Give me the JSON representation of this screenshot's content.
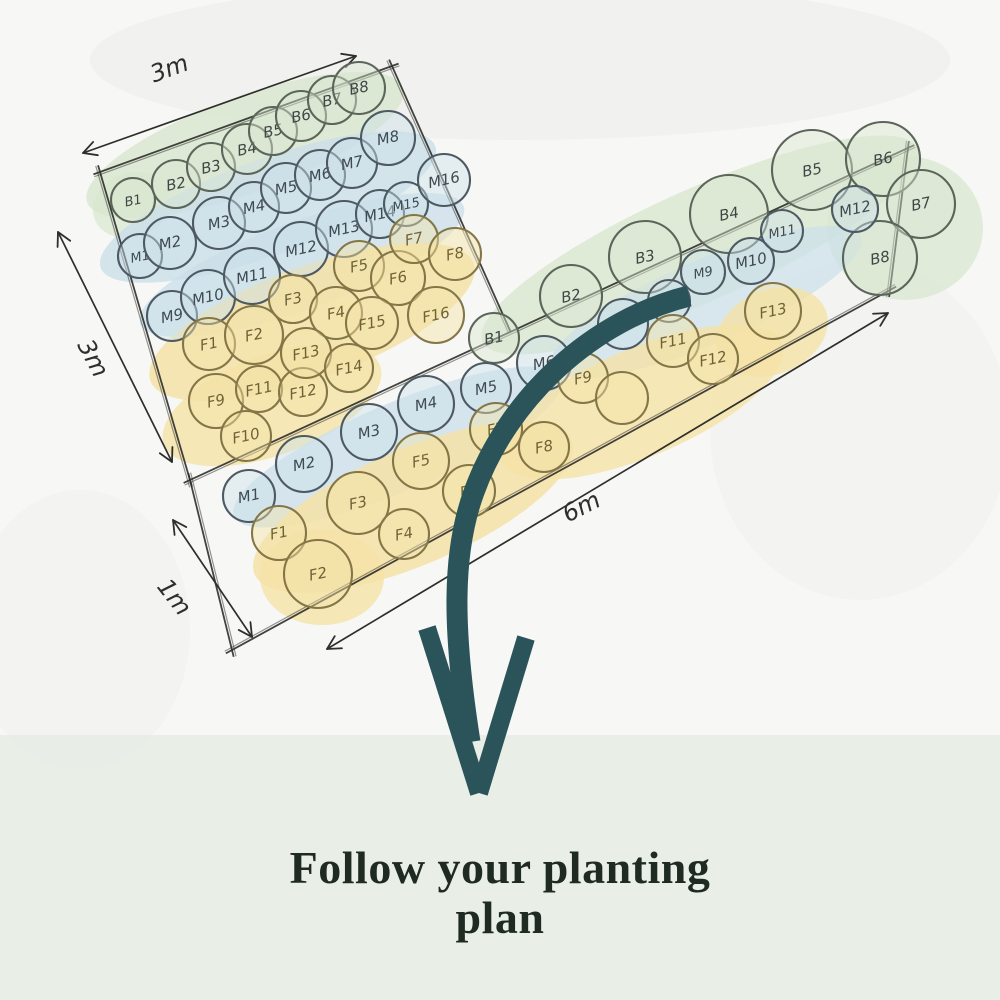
{
  "caption": {
    "line1": "Follow your planting",
    "line2": "plan"
  },
  "colors": {
    "paper": "#f7f7f5",
    "band": "#e9efe7",
    "green": "#d9e7d0",
    "blue": "#cbdfe9",
    "yellow": "#f5e2a6",
    "gray": "#ececea",
    "ink": "#2e2e2a",
    "teal": "#2a545a",
    "b_stroke": "#5c655a",
    "m_stroke": "#4d5a63",
    "f_stroke": "#857647",
    "b_text": "#3f4746",
    "m_text": "#3f4a52",
    "f_text": "#6f6236",
    "caption_text": "#1f2a22"
  },
  "dimensions": [
    {
      "label": "3m",
      "x1": 83,
      "y1": 153,
      "x2": 356,
      "y2": 56,
      "lx": 172,
      "ly": 76,
      "angle": -20
    },
    {
      "label": "3m",
      "x1": 58,
      "y1": 232,
      "x2": 172,
      "y2": 462,
      "lx": 86,
      "ly": 362,
      "angle": 62
    },
    {
      "label": "1m",
      "x1": 173,
      "y1": 520,
      "x2": 252,
      "y2": 637,
      "lx": 168,
      "ly": 602,
      "angle": 52
    },
    {
      "label": "6m",
      "x1": 327,
      "y1": 649,
      "x2": 888,
      "y2": 313,
      "lx": 585,
      "ly": 514,
      "angle": -27
    }
  ],
  "bed_edges": [
    [
      100,
      172,
      392,
      66
    ],
    [
      392,
      66,
      508,
      326
    ],
    [
      190,
      480,
      908,
      148
    ],
    [
      908,
      148,
      890,
      290
    ],
    [
      890,
      290,
      232,
      650
    ],
    [
      232,
      650,
      190,
      480
    ],
    [
      100,
      172,
      190,
      480
    ]
  ],
  "wash_format": [
    "cx",
    "cy",
    "rx",
    "ry",
    "rotate",
    "color_key",
    "opacity"
  ],
  "washes": [
    [
      520,
      60,
      430,
      80,
      0,
      "gray",
      0.55
    ],
    [
      860,
      430,
      150,
      170,
      0,
      "gray",
      0.3
    ],
    [
      80,
      630,
      110,
      140,
      0,
      "gray",
      0.35
    ],
    [
      245,
      145,
      168,
      48,
      -20,
      "green",
      0.85
    ],
    [
      132,
      205,
      40,
      32,
      -20,
      "green",
      0.7
    ],
    [
      268,
      207,
      178,
      48,
      -20,
      "blue",
      0.8
    ],
    [
      302,
      265,
      172,
      44,
      -20,
      "blue",
      0.75
    ],
    [
      312,
      322,
      172,
      56,
      -20,
      "yellow",
      0.85
    ],
    [
      272,
      405,
      115,
      50,
      -20,
      "yellow",
      0.8
    ],
    [
      700,
      245,
      238,
      56,
      -24,
      "green",
      0.8
    ],
    [
      905,
      228,
      78,
      72,
      0,
      "green",
      0.75
    ],
    [
      398,
      447,
      178,
      44,
      -23,
      "blue",
      0.75
    ],
    [
      706,
      302,
      168,
      42,
      -23,
      "blue",
      0.7
    ],
    [
      413,
      507,
      172,
      58,
      -23,
      "yellow",
      0.85
    ],
    [
      642,
      402,
      152,
      54,
      -23,
      "yellow",
      0.8
    ],
    [
      772,
      332,
      58,
      42,
      -23,
      "yellow",
      0.8
    ],
    [
      322,
      577,
      62,
      48,
      0,
      "yellow",
      0.8
    ]
  ],
  "plant_format": [
    "label",
    "row_type",
    "x",
    "y",
    "radius"
  ],
  "left_bed_plants": [
    [
      "B1",
      "B",
      133,
      200,
      22
    ],
    [
      "B2",
      "B",
      176,
      184,
      24
    ],
    [
      "B3",
      "B",
      211,
      167,
      24
    ],
    [
      "B4",
      "B",
      247,
      149,
      25
    ],
    [
      "B5",
      "B",
      273,
      131,
      24
    ],
    [
      "B6",
      "B",
      301,
      116,
      25
    ],
    [
      "B7",
      "B",
      332,
      100,
      24
    ],
    [
      "B8",
      "B",
      359,
      88,
      26
    ],
    [
      "M1",
      "M",
      140,
      256,
      22
    ],
    [
      "M2",
      "M",
      170,
      243,
      26
    ],
    [
      "M3",
      "M",
      219,
      223,
      26
    ],
    [
      "M4",
      "M",
      254,
      207,
      25
    ],
    [
      "M5",
      "M",
      286,
      188,
      25
    ],
    [
      "M6",
      "M",
      320,
      175,
      25
    ],
    [
      "M7",
      "M",
      352,
      163,
      25
    ],
    [
      "M8",
      "M",
      388,
      138,
      27
    ],
    [
      "M9",
      "M",
      172,
      316,
      25
    ],
    [
      "M10",
      "M",
      208,
      297,
      27
    ],
    [
      "M11",
      "M",
      252,
      276,
      28
    ],
    [
      "M12",
      "M",
      301,
      249,
      27
    ],
    [
      "M13",
      "M",
      344,
      229,
      28
    ],
    [
      "M14",
      "M",
      380,
      214,
      24
    ],
    [
      "M15",
      "M",
      406,
      204,
      22
    ],
    [
      "M16",
      "M",
      444,
      180,
      26
    ],
    [
      "F1",
      "F",
      209,
      344,
      26
    ],
    [
      "F2",
      "F",
      254,
      335,
      29
    ],
    [
      "F3",
      "F",
      293,
      299,
      24
    ],
    [
      "F4",
      "F",
      336,
      313,
      26
    ],
    [
      "F5",
      "F",
      359,
      266,
      25
    ],
    [
      "F6",
      "F",
      398,
      278,
      27
    ],
    [
      "F7",
      "F",
      414,
      239,
      24
    ],
    [
      "F8",
      "F",
      455,
      254,
      26
    ],
    [
      "F9",
      "F",
      216,
      401,
      27
    ],
    [
      "F10",
      "F",
      246,
      436,
      25
    ],
    [
      "F11",
      "F",
      259,
      389,
      23
    ],
    [
      "F12",
      "F",
      303,
      392,
      24
    ],
    [
      "F13",
      "F",
      306,
      353,
      25
    ],
    [
      "F14",
      "F",
      349,
      368,
      24
    ],
    [
      "F15",
      "F",
      372,
      323,
      26
    ],
    [
      "F16",
      "F",
      436,
      315,
      28
    ]
  ],
  "right_bed_plants": [
    [
      "B1",
      "B",
      494,
      338,
      25
    ],
    [
      "B2",
      "B",
      571,
      296,
      31
    ],
    [
      "B3",
      "B",
      645,
      257,
      36
    ],
    [
      "B4",
      "B",
      729,
      214,
      39
    ],
    [
      "B5",
      "B",
      812,
      170,
      40
    ],
    [
      "B6",
      "B",
      883,
      159,
      37
    ],
    [
      "B7",
      "B",
      921,
      204,
      34
    ],
    [
      "B8",
      "B",
      880,
      258,
      37
    ],
    [
      "M1",
      "M",
      249,
      496,
      26
    ],
    [
      "M2",
      "M",
      304,
      464,
      28
    ],
    [
      "M3",
      "M",
      369,
      432,
      28
    ],
    [
      "M4",
      "M",
      426,
      404,
      28
    ],
    [
      "M5",
      "M",
      486,
      388,
      25
    ],
    [
      "M6",
      "M",
      544,
      363,
      27
    ],
    [
      "M7",
      "M",
      623,
      324,
      25
    ],
    [
      "M8",
      "M",
      669,
      301,
      21
    ],
    [
      "M9",
      "M",
      703,
      272,
      22
    ],
    [
      "M10",
      "M",
      751,
      261,
      23
    ],
    [
      "M11",
      "M",
      782,
      231,
      21
    ],
    [
      "M12",
      "M",
      855,
      209,
      23
    ],
    [
      "F1",
      "F",
      279,
      533,
      27
    ],
    [
      "F2",
      "F",
      318,
      574,
      34
    ],
    [
      "F3",
      "F",
      358,
      503,
      31
    ],
    [
      "F4",
      "F",
      404,
      534,
      25
    ],
    [
      "F5",
      "F",
      421,
      461,
      28
    ],
    [
      "F6",
      "F",
      469,
      491,
      26
    ],
    [
      "F7",
      "F",
      496,
      429,
      26
    ],
    [
      "F8",
      "F",
      544,
      447,
      25
    ],
    [
      "F9",
      "F",
      583,
      378,
      25
    ],
    [
      "",
      "F",
      622,
      398,
      26
    ],
    [
      "F11",
      "F",
      673,
      341,
      26
    ],
    [
      "F12",
      "F",
      713,
      359,
      25
    ],
    [
      "F13",
      "F",
      773,
      311,
      28
    ]
  ],
  "arrow": {
    "shaft_path": "M689,296 C592,320 508,398 474,492 C452,552 452,628 470,742",
    "barbs": [
      [
        427,
        628,
        479,
        793
      ],
      [
        526,
        638,
        479,
        793
      ]
    ],
    "shaft_width": 21,
    "barb_width": 18
  },
  "band_top": 735
}
